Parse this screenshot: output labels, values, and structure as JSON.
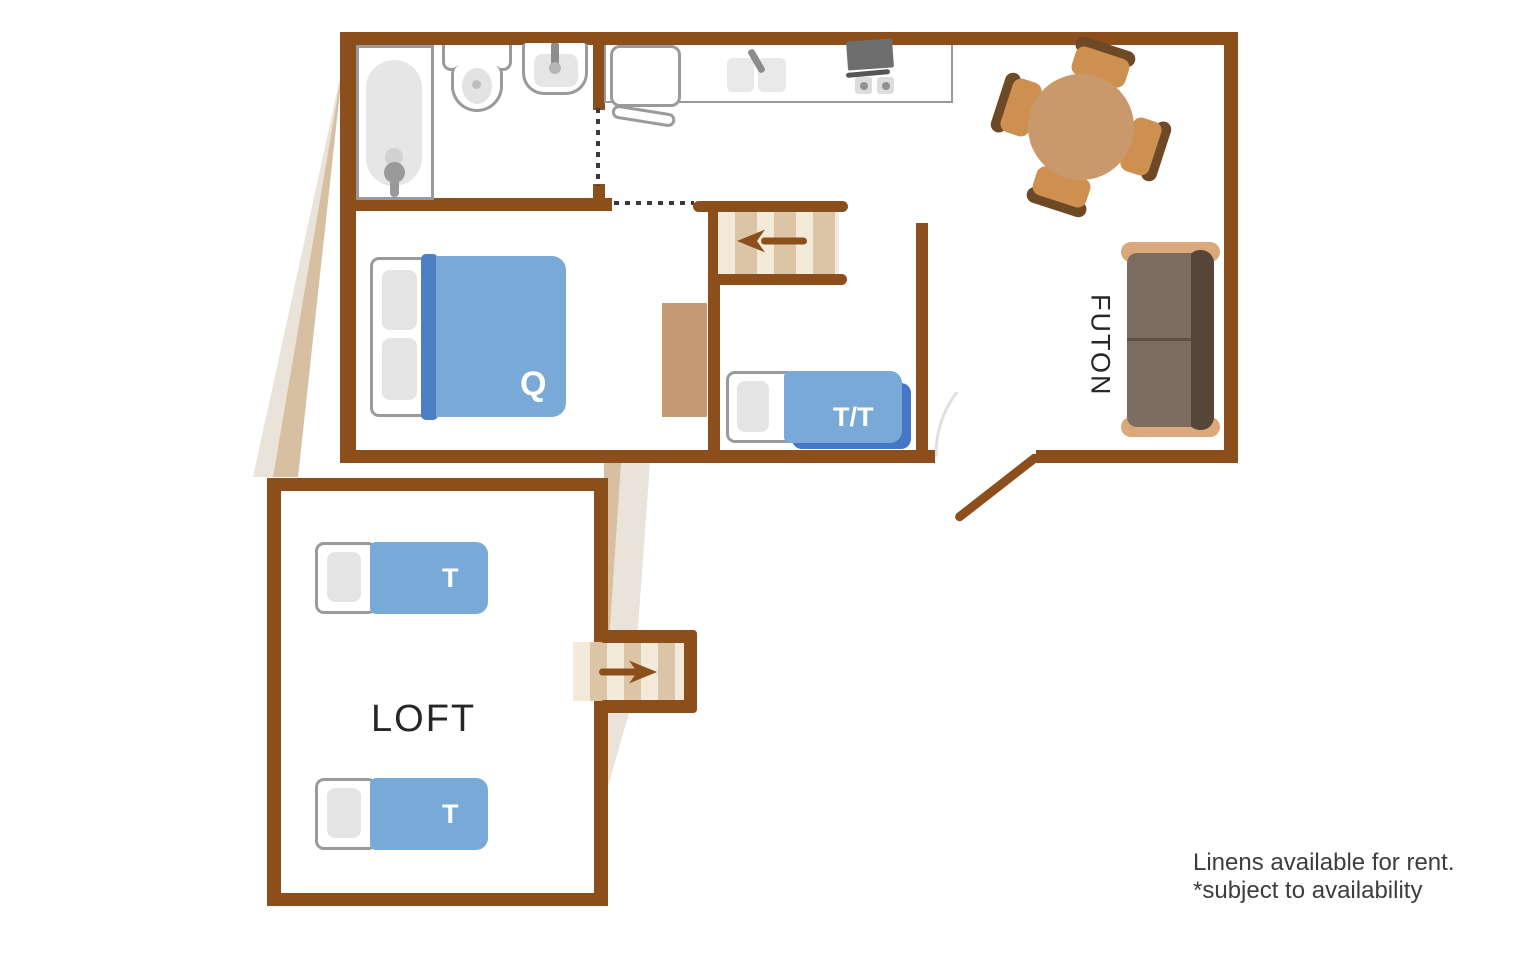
{
  "floorplan": {
    "labels": {
      "queen_bed": "Q",
      "twin_trundle_bed": "T/T",
      "loft_bed_top": "T",
      "loft_bed_bottom": "T",
      "loft_room": "LOFT",
      "futon": "FUTON"
    },
    "note": {
      "line1": "Linens available for rent.",
      "line2": "*subject to availability"
    },
    "icons": {
      "stairs_arrow_up": "left-arrow",
      "stairs_arrow_down": "right-arrow"
    },
    "colors": {
      "wall": "#8C4F1C",
      "bed_blue": "#79AAD7",
      "bed_blue_dark": "#4C7FC5",
      "trundle_blue": "#4477C8",
      "stair_light": "#F4EAD9",
      "stair_dark": "#DCC5A6",
      "table_wood": "#C9996C",
      "chair_wood": "#CE9050",
      "chair_shadow": "#6D4A25",
      "futon_frame": "#D9A97B",
      "futon_cushion": "#7C6D60",
      "futon_seam": "#5D5044",
      "futon_back": "#554639",
      "fixture_line": "#9A9A9A",
      "fixture_fill": "#E6E6E6",
      "shadow_light": "#EAE3DA",
      "shadow_tan": "#D7BFA2",
      "ink": "#3D3D3D"
    }
  }
}
